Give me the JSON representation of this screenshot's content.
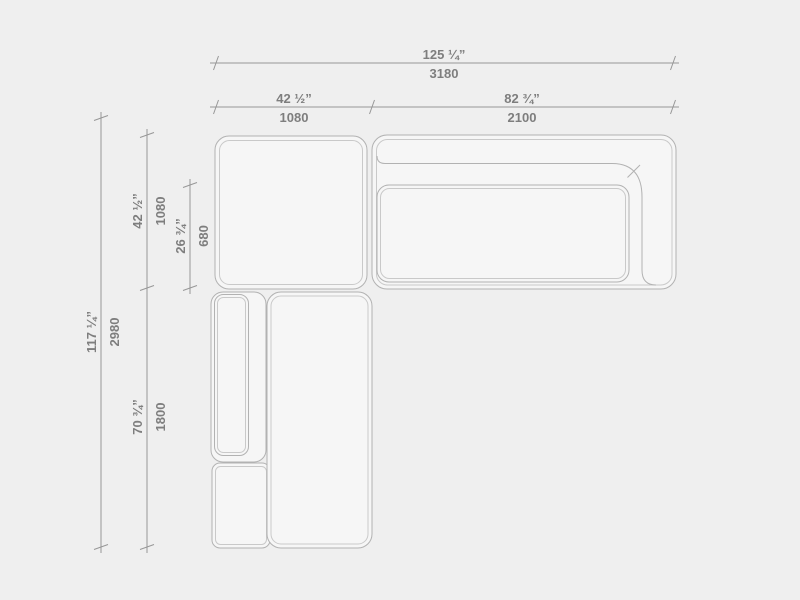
{
  "page": {
    "background": "#efefef",
    "description": "Technical top-view dimension drawing of a modular corner sofa with chaise"
  },
  "drawing": {
    "fill_color": "#f6f6f6",
    "outline_color": "#b2b2b2",
    "inner_line_color": "#c9c9c9",
    "dimension_line_color": "#979797",
    "dimension_text_color": "#7e7e7e",
    "modules": [
      "left-seat-module",
      "right-sofa-section-with-backrest-and-armrest",
      "chaise-section-with-left-armrest"
    ],
    "dimensions": {
      "overall_width": {
        "inches": "125 ¼”",
        "mm": "3180"
      },
      "left_section_width": {
        "inches": "42 ½”",
        "mm": "1080"
      },
      "right_section_width": {
        "inches": "82 ¾”",
        "mm": "2100"
      },
      "overall_depth": {
        "inches": "117 ¼”",
        "mm": "2980"
      },
      "top_module_depth": {
        "inches": "42 ½”",
        "mm": "1080"
      },
      "seat_depth": {
        "inches": "26 ¾”",
        "mm": "680"
      },
      "chaise_depth": {
        "inches": "70 ¾”",
        "mm": "1800"
      }
    }
  }
}
